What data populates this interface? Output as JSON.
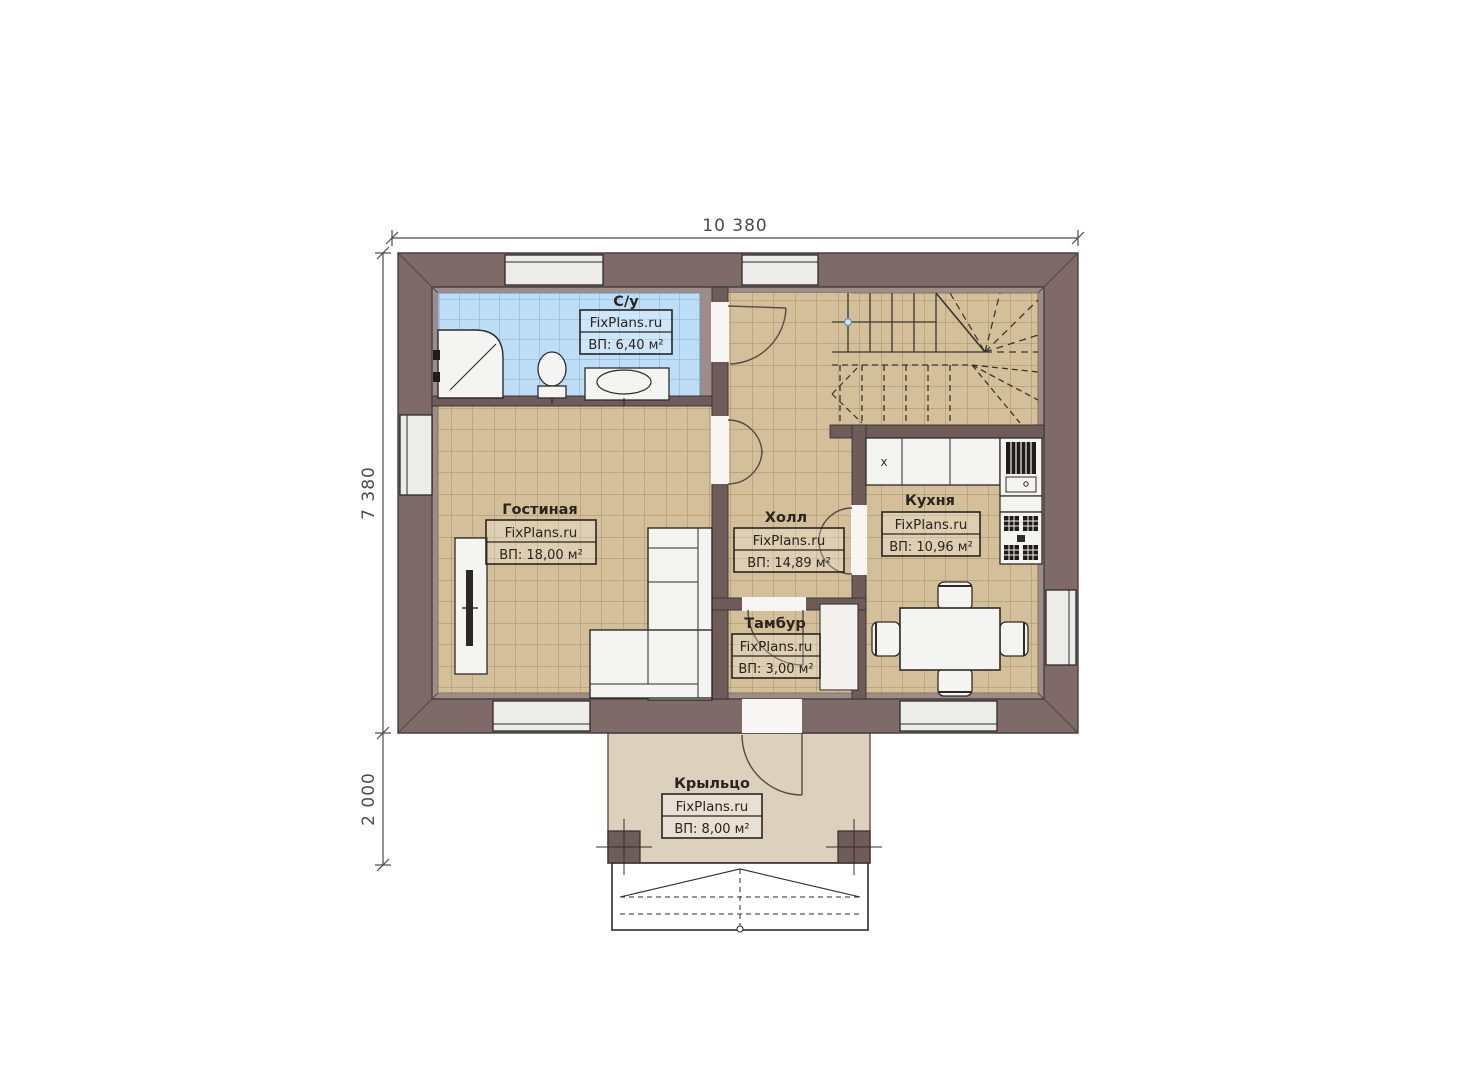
{
  "plan": {
    "brand": "FixPlans.ru",
    "dimensions": {
      "width_top": "10 380",
      "height_main": "7 380",
      "porch_depth": "2 000"
    },
    "rooms": [
      {
        "name": "С/у",
        "brand": "FixPlans.ru",
        "area": "ВП: 6,40 м²"
      },
      {
        "name": "Гостиная",
        "brand": "FixPlans.ru",
        "area": "ВП: 18,00 м²"
      },
      {
        "name": "Холл",
        "brand": "FixPlans.ru",
        "area": "ВП: 14,89 м²"
      },
      {
        "name": "Кухня",
        "brand": "FixPlans.ru",
        "area": "ВП: 10,96 м²"
      },
      {
        "name": "Тамбур",
        "brand": "FixPlans.ru",
        "area": "ВП: 3,00 м²"
      },
      {
        "name": "Крыльцо",
        "brand": "FixPlans.ru",
        "area": "ВП: 8,00 м²"
      }
    ],
    "markers": {
      "sink": "x"
    },
    "colors": {
      "wall": "#7e6a69",
      "wall_inner_border": "#9d8c89",
      "partition": "#6e5b5a",
      "floor_tan": "#d3bf9a",
      "floor_tan_grid": "#a78e63",
      "floor_blue": "#bedef7",
      "floor_blue_grid": "#82abd0",
      "porch_floor": "#ddd0bd",
      "fixture": "#f4f4f2",
      "line": "#332e29"
    }
  }
}
